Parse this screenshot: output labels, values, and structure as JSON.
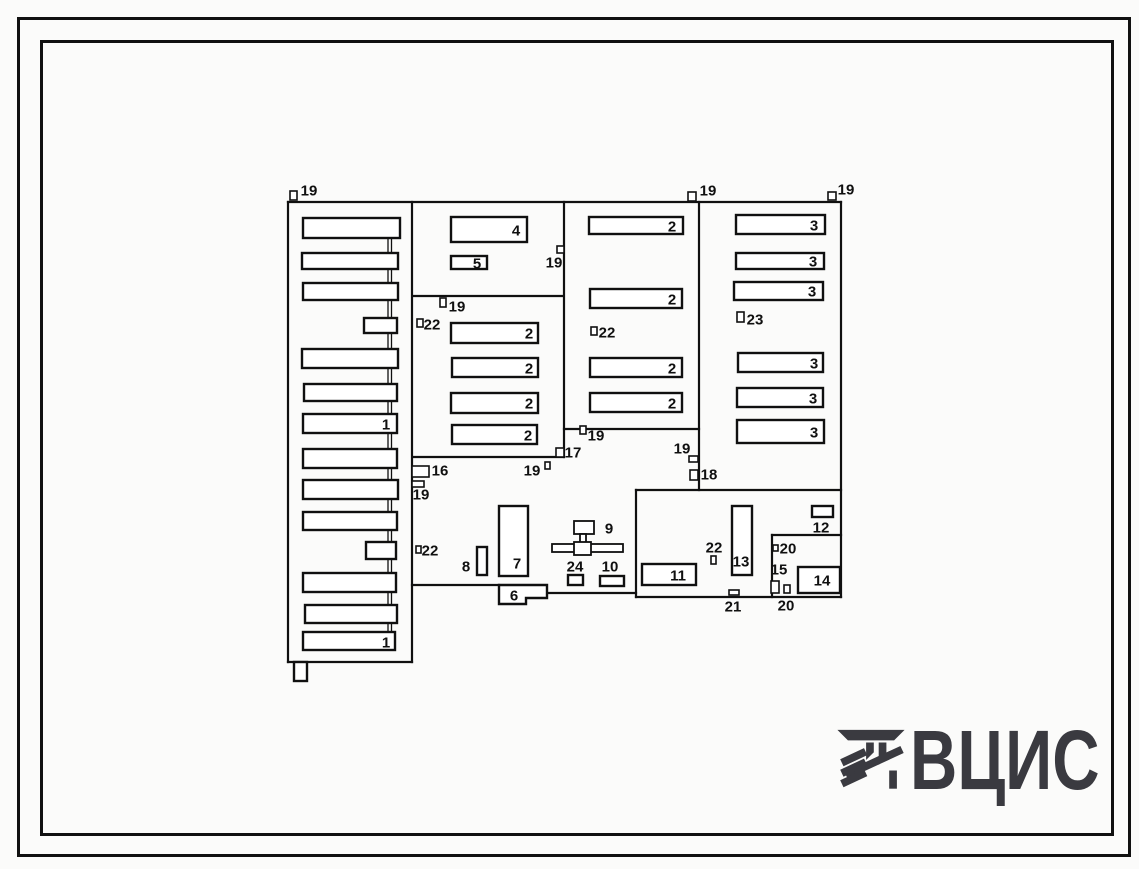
{
  "logo": {
    "text": "ВЦИС",
    "color": "#3a3a40"
  },
  "plan": {
    "stroke": "#101010",
    "label_font_px": 15,
    "boundaries": [
      [
        288,
        202,
        841,
        202
      ],
      [
        288,
        202,
        288,
        662
      ],
      [
        288,
        662,
        412,
        662
      ],
      [
        412,
        202,
        412,
        662
      ],
      [
        413,
        296,
        563,
        296
      ],
      [
        564,
        202,
        564,
        457
      ],
      [
        413,
        457,
        564,
        457
      ],
      [
        564,
        429,
        699,
        429
      ],
      [
        699,
        202,
        699,
        490
      ],
      [
        841,
        202,
        841,
        597
      ],
      [
        412,
        585,
        499,
        585
      ],
      [
        547,
        593,
        636,
        593
      ],
      [
        636,
        490,
        841,
        490
      ],
      [
        636,
        490,
        636,
        597
      ],
      [
        636,
        597,
        841,
        597
      ],
      [
        772,
        535,
        841,
        535
      ],
      [
        772,
        535,
        772,
        597
      ],
      [
        388,
        228,
        388,
        641,
        1.3
      ],
      [
        391.5,
        228,
        391.5,
        641,
        1.3
      ]
    ],
    "buildings": [
      {
        "x": 303,
        "y": 218,
        "w": 97,
        "h": 20,
        "label": ""
      },
      {
        "x": 302,
        "y": 253,
        "w": 96,
        "h": 16,
        "label": ""
      },
      {
        "x": 303,
        "y": 283,
        "w": 95,
        "h": 17,
        "label": ""
      },
      {
        "x": 364,
        "y": 318,
        "w": 33,
        "h": 15,
        "label": ""
      },
      {
        "x": 302,
        "y": 349,
        "w": 96,
        "h": 19,
        "label": ""
      },
      {
        "x": 304,
        "y": 384,
        "w": 93,
        "h": 17,
        "label": ""
      },
      {
        "x": 303,
        "y": 414,
        "w": 94,
        "h": 19,
        "label": "1",
        "lx": 386,
        "ly": 424
      },
      {
        "x": 303,
        "y": 449,
        "w": 94,
        "h": 19,
        "label": ""
      },
      {
        "x": 303,
        "y": 480,
        "w": 95,
        "h": 19,
        "label": ""
      },
      {
        "x": 303,
        "y": 512,
        "w": 94,
        "h": 18,
        "label": ""
      },
      {
        "x": 366,
        "y": 542,
        "w": 30,
        "h": 17,
        "label": ""
      },
      {
        "x": 303,
        "y": 573,
        "w": 93,
        "h": 19,
        "label": ""
      },
      {
        "x": 305,
        "y": 605,
        "w": 92,
        "h": 18,
        "label": ""
      },
      {
        "x": 303,
        "y": 632,
        "w": 92,
        "h": 18,
        "label": "1",
        "lx": 386,
        "ly": 642
      },
      {
        "x": 294,
        "y": 662,
        "w": 13,
        "h": 19,
        "label": ""
      },
      {
        "x": 451,
        "y": 217,
        "w": 76,
        "h": 25,
        "label": "4",
        "lx": 516,
        "ly": 230
      },
      {
        "x": 451,
        "y": 256,
        "w": 36,
        "h": 13,
        "label": "5",
        "lx": 477,
        "ly": 263
      },
      {
        "x": 451,
        "y": 323,
        "w": 87,
        "h": 20,
        "label": "2",
        "lx": 529,
        "ly": 333
      },
      {
        "x": 452,
        "y": 358,
        "w": 86,
        "h": 19,
        "label": "2",
        "lx": 529,
        "ly": 368
      },
      {
        "x": 451,
        "y": 393,
        "w": 87,
        "h": 20,
        "label": "2",
        "lx": 529,
        "ly": 403
      },
      {
        "x": 452,
        "y": 425,
        "w": 85,
        "h": 19,
        "label": "2",
        "lx": 528,
        "ly": 435
      },
      {
        "x": 589,
        "y": 217,
        "w": 94,
        "h": 17,
        "label": "2",
        "lx": 672,
        "ly": 226
      },
      {
        "x": 590,
        "y": 289,
        "w": 92,
        "h": 19,
        "label": "2",
        "lx": 672,
        "ly": 299
      },
      {
        "x": 590,
        "y": 358,
        "w": 92,
        "h": 19,
        "label": "2",
        "lx": 672,
        "ly": 368
      },
      {
        "x": 590,
        "y": 393,
        "w": 92,
        "h": 19,
        "label": "2",
        "lx": 672,
        "ly": 403
      },
      {
        "x": 736,
        "y": 215,
        "w": 89,
        "h": 19,
        "label": "3",
        "lx": 814,
        "ly": 225
      },
      {
        "x": 736,
        "y": 253,
        "w": 88,
        "h": 16,
        "label": "3",
        "lx": 813,
        "ly": 261
      },
      {
        "x": 734,
        "y": 282,
        "w": 89,
        "h": 18,
        "label": "3",
        "lx": 812,
        "ly": 291
      },
      {
        "x": 738,
        "y": 353,
        "w": 85,
        "h": 19,
        "label": "3",
        "lx": 814,
        "ly": 363
      },
      {
        "x": 737,
        "y": 388,
        "w": 86,
        "h": 19,
        "label": "3",
        "lx": 813,
        "ly": 398
      },
      {
        "x": 737,
        "y": 420,
        "w": 87,
        "h": 23,
        "label": "3",
        "lx": 814,
        "ly": 432
      },
      {
        "x": 499,
        "y": 506,
        "w": 29,
        "h": 70,
        "label": "7",
        "lx": 517,
        "ly": 563
      },
      {
        "x": 477,
        "y": 547,
        "w": 10,
        "h": 28,
        "label": "8",
        "lx": 466,
        "ly": 566
      },
      {
        "x": 642,
        "y": 564,
        "w": 54,
        "h": 21,
        "label": "11",
        "lx": 678,
        "ly": 575
      },
      {
        "x": 732,
        "y": 506,
        "w": 20,
        "h": 69,
        "label": "13",
        "lx": 741,
        "ly": 561
      },
      {
        "x": 798,
        "y": 567,
        "w": 42,
        "h": 26,
        "label": "14",
        "lx": 822,
        "ly": 580
      },
      {
        "x": 812,
        "y": 506,
        "w": 21,
        "h": 11,
        "label": "12",
        "lx": 821,
        "ly": 527
      },
      {
        "x": 600,
        "y": 576,
        "w": 24,
        "h": 10,
        "label": "10",
        "lx": 610,
        "ly": 566
      },
      {
        "x": 568,
        "y": 575,
        "w": 15,
        "h": 10,
        "label": "24",
        "lx": 575,
        "ly": 566
      }
    ],
    "polygons": [
      {
        "points": "499,585 547,585 547,598 526,598 526,604 499,604",
        "label": "6",
        "lx": 514,
        "ly": 595
      }
    ],
    "assembly": {
      "label": "9",
      "lx": 609,
      "ly": 528,
      "rects": [
        {
          "x": 574,
          "y": 521,
          "w": 20,
          "h": 13
        },
        {
          "x": 580,
          "y": 534,
          "w": 6,
          "h": 10
        },
        {
          "x": 552,
          "y": 544,
          "w": 71,
          "h": 8
        },
        {
          "x": 574,
          "y": 542,
          "w": 17,
          "h": 13
        }
      ]
    },
    "markers": [
      {
        "x": 290,
        "y": 191,
        "w": 7,
        "h": 9,
        "label": "19",
        "lx": 309,
        "ly": 190
      },
      {
        "x": 688,
        "y": 192,
        "w": 8,
        "h": 9,
        "label": "19",
        "lx": 708,
        "ly": 190
      },
      {
        "x": 828,
        "y": 192,
        "w": 8,
        "h": 8,
        "label": "19",
        "lx": 846,
        "ly": 189
      },
      {
        "x": 557,
        "y": 246,
        "w": 7,
        "h": 7,
        "label": "19",
        "lx": 554,
        "ly": 262
      },
      {
        "x": 440,
        "y": 298,
        "w": 6,
        "h": 9,
        "label": "19",
        "lx": 457,
        "ly": 306
      },
      {
        "x": 417,
        "y": 319,
        "w": 6,
        "h": 8,
        "label": "22",
        "lx": 432,
        "ly": 324
      },
      {
        "x": 591,
        "y": 327,
        "w": 6,
        "h": 8,
        "label": "22",
        "lx": 607,
        "ly": 332
      },
      {
        "x": 737,
        "y": 312,
        "w": 7,
        "h": 10,
        "label": "23",
        "lx": 755,
        "ly": 319
      },
      {
        "x": 545,
        "y": 462,
        "w": 5,
        "h": 7,
        "label": "19",
        "lx": 532,
        "ly": 470
      },
      {
        "x": 556,
        "y": 448,
        "w": 8,
        "h": 9,
        "label": "17",
        "lx": 573,
        "ly": 452
      },
      {
        "x": 580,
        "y": 426,
        "w": 6,
        "h": 8,
        "label": "19",
        "lx": 596,
        "ly": 435
      },
      {
        "x": 689,
        "y": 456,
        "w": 9,
        "h": 6,
        "label": "19",
        "lx": 682,
        "ly": 448
      },
      {
        "x": 690,
        "y": 470,
        "w": 8,
        "h": 10,
        "label": "18",
        "lx": 709,
        "ly": 474
      },
      {
        "x": 412,
        "y": 466,
        "w": 17,
        "h": 11,
        "label": "16",
        "lx": 440,
        "ly": 470
      },
      {
        "x": 412,
        "y": 481,
        "w": 12,
        "h": 6,
        "label": "19",
        "lx": 421,
        "ly": 494
      },
      {
        "x": 416,
        "y": 546,
        "w": 5,
        "h": 7,
        "label": "22",
        "lx": 430,
        "ly": 550
      },
      {
        "x": 711,
        "y": 556,
        "w": 5,
        "h": 8,
        "label": "22",
        "lx": 714,
        "ly": 547
      },
      {
        "x": 773,
        "y": 545,
        "w": 5,
        "h": 6,
        "label": "20",
        "lx": 788,
        "ly": 548
      },
      {
        "x": 771,
        "y": 581,
        "w": 8,
        "h": 12,
        "label": "15",
        "lx": 779,
        "ly": 569
      },
      {
        "x": 784,
        "y": 585,
        "w": 6,
        "h": 8,
        "label": "20",
        "lx": 786,
        "ly": 605
      },
      {
        "x": 729,
        "y": 590,
        "w": 10,
        "h": 5,
        "label": "21",
        "lx": 733,
        "ly": 606
      }
    ]
  }
}
